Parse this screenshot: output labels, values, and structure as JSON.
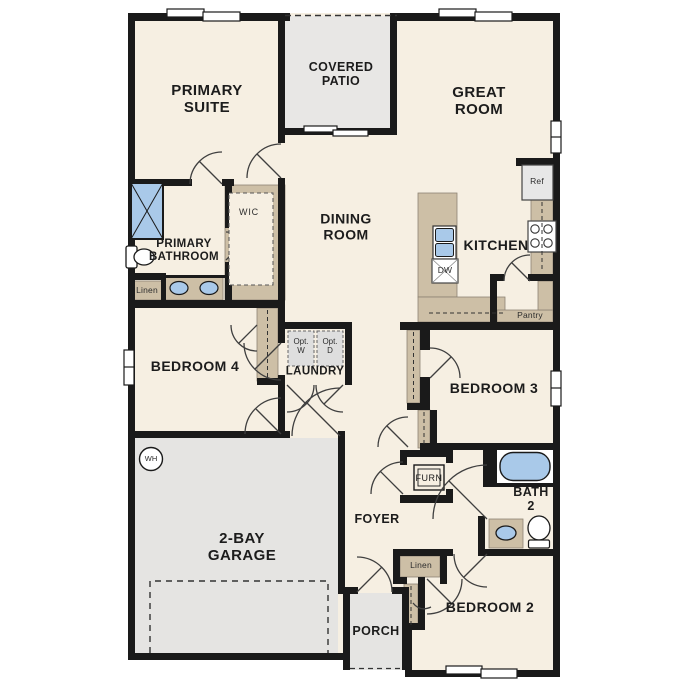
{
  "floorplan": {
    "labels": {
      "primary_suite": "PRIMARY\nSUITE",
      "covered_patio": "COVERED\nPATIO",
      "great_room": "GREAT\nROOM",
      "dining_room": "DINING\nROOM",
      "kitchen": "KITCHEN",
      "primary_bathroom": "PRIMARY\nBATHROOM",
      "wic": "WIC",
      "linen_bath": "Linen",
      "bedroom4": "BEDROOM 4",
      "laundry": "LAUNDRY",
      "opt_w": "Opt.\nW",
      "opt_d": "Opt.\nD",
      "bedroom3": "BEDROOM 3",
      "garage": "2-BAY\nGARAGE",
      "wh": "WH",
      "foyer": "FOYER",
      "furn": "FURN",
      "bath2": "BATH\n2",
      "linen_hall": "Linen",
      "bedroom2": "BEDROOM 2",
      "porch": "PORCH",
      "ref": "Ref",
      "dw": "DW",
      "pantry": "Pantry"
    },
    "colors": {
      "floor": "#f6efe2",
      "wall": "#1a1a1a",
      "hard_surface_gray": "#e5e4e2",
      "cabinet_tan": "#cdbfa6",
      "fixture_blue": "#a9c9e9"
    },
    "icons": [
      "shower-icon",
      "toilet-icon",
      "double-sink-icon",
      "kitchen-sink-icon",
      "dishwasher-icon",
      "refrigerator-icon",
      "stove-icon",
      "bathtub-icon",
      "washer-icon",
      "dryer-icon",
      "water-heater-icon",
      "furnace-icon",
      "window-icon",
      "sliding-door-icon",
      "door-swing-icon",
      "garage-door-icon"
    ]
  }
}
